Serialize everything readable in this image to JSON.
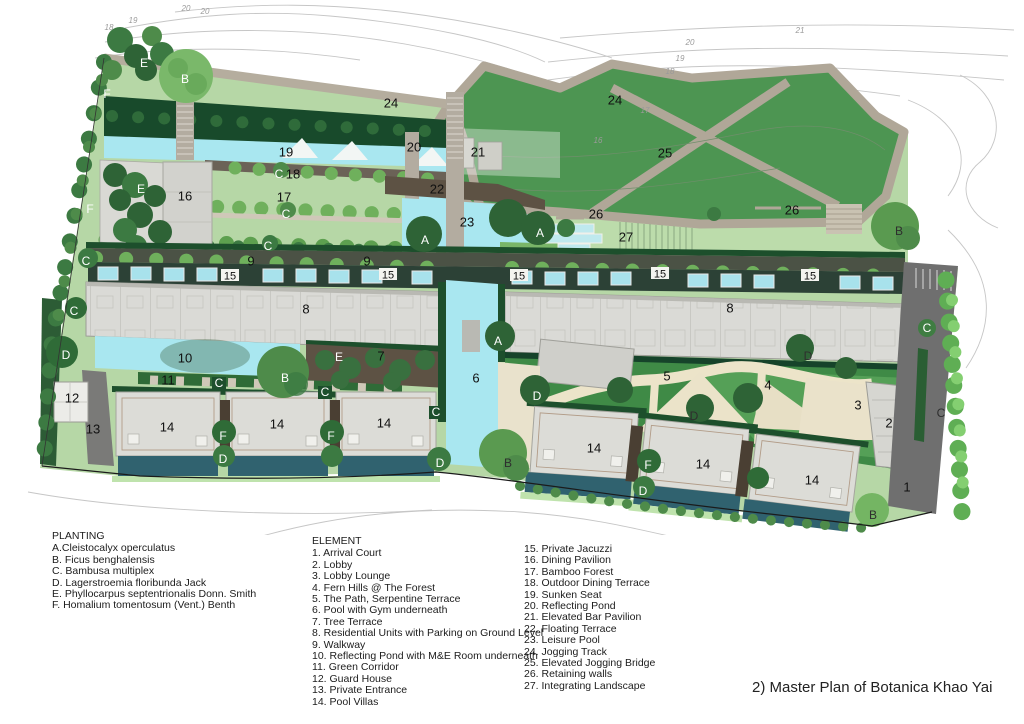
{
  "title": "2) Master Plan of Botanica Khao Yai",
  "legend": {
    "planting": {
      "heading": "PLANTING",
      "items": [
        "A.Cleistocalyx operculatus",
        "B. Ficus benghalensis",
        "C. Bambusa multiplex",
        "D. Lagerstroemia floribunda Jack",
        "E. Phyllocarpus septentrionalis Donn. Smith",
        "F. Homalium tomentosum (Vent.) Benth"
      ]
    },
    "element": {
      "heading": "ELEMENT",
      "col1": [
        "1. Arrival Court",
        "2. Lobby",
        "3. Lobby Lounge",
        "4. Fern Hills @ The Forest",
        "5. The Path, Serpentine Terrace",
        "6. Pool with Gym underneath",
        "7. Tree Terrace",
        "8. Residential Units with Parking on Ground Level",
        "9. Walkway",
        "10. Reflecting Pond with M&E Room underneath",
        "11. Green Corridor",
        "12. Guard House",
        "13. Private Entrance",
        "14. Pool Villas"
      ],
      "col2": [
        "15. Private Jacuzzi",
        "16. Dining Pavilion",
        "17. Bamboo Forest",
        "18. Outdoor Dining Terrace",
        "19. Sunken Seat",
        "20. Reflecting Pond",
        "21. Elevated Bar Pavilion",
        "22. Floating Terrace",
        "23. Leisure Pool",
        "24. Jogging Track",
        "25. Elevated Jogging Bridge",
        "26. Retaining walls",
        "27. Integrating Landscape"
      ]
    }
  },
  "plan": {
    "palette": {
      "water": "#a9e7f0",
      "pool_villa_water": "#30626f",
      "lawn": "#b6d7a6",
      "hill_green": "#4d9552",
      "forest_dark": "#184a2b",
      "serpentine_green": "#3f8a46",
      "track_tan": "#b0a798",
      "sand_path": "#ece4c9",
      "building_gray": "#dadad6",
      "terrace_brown": "#5d5244",
      "road_gray": "#6f6f6f",
      "contour_gray": "#c6c6c6"
    },
    "markers": [
      {
        "t": "1",
        "x": 907,
        "y": 487,
        "k": "n"
      },
      {
        "t": "2",
        "x": 889,
        "y": 423,
        "k": "n"
      },
      {
        "t": "3",
        "x": 858,
        "y": 405,
        "k": "n"
      },
      {
        "t": "4",
        "x": 768,
        "y": 385,
        "k": "n"
      },
      {
        "t": "5",
        "x": 667,
        "y": 376,
        "k": "n"
      },
      {
        "t": "6",
        "x": 476,
        "y": 378,
        "k": "n"
      },
      {
        "t": "7",
        "x": 381,
        "y": 356,
        "k": "n"
      },
      {
        "t": "8",
        "x": 306,
        "y": 309,
        "k": "n"
      },
      {
        "t": "8",
        "x": 730,
        "y": 308,
        "k": "n"
      },
      {
        "t": "9",
        "x": 251,
        "y": 261,
        "k": "n"
      },
      {
        "t": "9",
        "x": 367,
        "y": 261,
        "k": "n"
      },
      {
        "t": "10",
        "x": 185,
        "y": 358,
        "k": "n"
      },
      {
        "t": "11",
        "x": 168,
        "y": 380,
        "k": "n"
      },
      {
        "t": "12",
        "x": 72,
        "y": 398,
        "k": "n"
      },
      {
        "t": "13",
        "x": 93,
        "y": 429,
        "k": "n"
      },
      {
        "t": "14",
        "x": 167,
        "y": 427,
        "k": "n"
      },
      {
        "t": "14",
        "x": 277,
        "y": 424,
        "k": "n"
      },
      {
        "t": "14",
        "x": 384,
        "y": 423,
        "k": "n"
      },
      {
        "t": "14",
        "x": 594,
        "y": 448,
        "k": "n"
      },
      {
        "t": "14",
        "x": 703,
        "y": 464,
        "k": "n"
      },
      {
        "t": "14",
        "x": 812,
        "y": 480,
        "k": "n"
      },
      {
        "t": "15",
        "x": 230,
        "y": 276,
        "k": "p"
      },
      {
        "t": "15",
        "x": 388,
        "y": 275,
        "k": "p"
      },
      {
        "t": "15",
        "x": 519,
        "y": 276,
        "k": "p"
      },
      {
        "t": "15",
        "x": 660,
        "y": 274,
        "k": "p"
      },
      {
        "t": "15",
        "x": 810,
        "y": 276,
        "k": "p"
      },
      {
        "t": "16",
        "x": 185,
        "y": 196,
        "k": "n"
      },
      {
        "t": "17",
        "x": 284,
        "y": 197,
        "k": "n"
      },
      {
        "t": "18",
        "x": 293,
        "y": 174,
        "k": "n"
      },
      {
        "t": "19",
        "x": 286,
        "y": 152,
        "k": "n"
      },
      {
        "t": "20",
        "x": 414,
        "y": 147,
        "k": "n"
      },
      {
        "t": "21",
        "x": 478,
        "y": 152,
        "k": "n"
      },
      {
        "t": "22",
        "x": 437,
        "y": 189,
        "k": "n"
      },
      {
        "t": "23",
        "x": 467,
        "y": 222,
        "k": "n"
      },
      {
        "t": "24",
        "x": 391,
        "y": 103,
        "k": "n"
      },
      {
        "t": "24",
        "x": 615,
        "y": 100,
        "k": "n"
      },
      {
        "t": "25",
        "x": 665,
        "y": 153,
        "k": "n"
      },
      {
        "t": "26",
        "x": 596,
        "y": 214,
        "k": "n"
      },
      {
        "t": "26",
        "x": 792,
        "y": 210,
        "k": "n"
      },
      {
        "t": "27",
        "x": 626,
        "y": 237,
        "k": "n"
      },
      {
        "t": "E",
        "x": 144,
        "y": 63,
        "k": "l",
        "c": "w"
      },
      {
        "t": "B",
        "x": 185,
        "y": 79,
        "k": "l",
        "c": "w"
      },
      {
        "t": "F",
        "x": 107,
        "y": 94,
        "k": "l",
        "c": "w"
      },
      {
        "t": "E",
        "x": 141,
        "y": 189,
        "k": "l",
        "c": "w"
      },
      {
        "t": "F",
        "x": 90,
        "y": 209,
        "k": "l",
        "c": "w"
      },
      {
        "t": "C",
        "x": 279,
        "y": 174,
        "k": "l",
        "c": "w"
      },
      {
        "t": "C",
        "x": 286,
        "y": 214,
        "k": "l",
        "c": "w"
      },
      {
        "t": "C",
        "x": 268,
        "y": 246,
        "k": "l",
        "c": "w"
      },
      {
        "t": "C",
        "x": 86,
        "y": 261,
        "k": "l",
        "c": "w"
      },
      {
        "t": "C",
        "x": 74,
        "y": 311,
        "k": "l",
        "c": "w"
      },
      {
        "t": "D",
        "x": 66,
        "y": 355,
        "k": "l",
        "c": "w"
      },
      {
        "t": "C",
        "x": 219,
        "y": 383,
        "k": "l",
        "c": "w"
      },
      {
        "t": "C",
        "x": 325,
        "y": 392,
        "k": "l",
        "c": "w"
      },
      {
        "t": "C",
        "x": 436,
        "y": 412,
        "k": "l",
        "c": "w"
      },
      {
        "t": "F",
        "x": 223,
        "y": 436,
        "k": "l",
        "c": "w"
      },
      {
        "t": "F",
        "x": 331,
        "y": 436,
        "k": "l",
        "c": "w"
      },
      {
        "t": "D",
        "x": 223,
        "y": 459,
        "k": "l",
        "c": "w"
      },
      {
        "t": "A",
        "x": 425,
        "y": 240,
        "k": "l",
        "c": "w"
      },
      {
        "t": "A",
        "x": 540,
        "y": 233,
        "k": "l",
        "c": "w"
      },
      {
        "t": "A",
        "x": 498,
        "y": 341,
        "k": "l",
        "c": "w"
      },
      {
        "t": "E",
        "x": 339,
        "y": 357,
        "k": "l",
        "c": "w"
      },
      {
        "t": "B",
        "x": 285,
        "y": 378,
        "k": "l",
        "c": "w"
      },
      {
        "t": "D",
        "x": 440,
        "y": 463,
        "k": "l",
        "c": "w"
      },
      {
        "t": "B",
        "x": 508,
        "y": 463,
        "k": "l",
        "c": "d"
      },
      {
        "t": "D",
        "x": 537,
        "y": 396,
        "k": "l",
        "c": "w"
      },
      {
        "t": "D",
        "x": 694,
        "y": 416,
        "k": "l",
        "c": "d"
      },
      {
        "t": "D",
        "x": 808,
        "y": 356,
        "k": "l",
        "c": "d"
      },
      {
        "t": "F",
        "x": 648,
        "y": 465,
        "k": "l",
        "c": "w"
      },
      {
        "t": "D",
        "x": 643,
        "y": 491,
        "k": "l",
        "c": "w"
      },
      {
        "t": "B",
        "x": 899,
        "y": 231,
        "k": "l",
        "c": "d"
      },
      {
        "t": "C",
        "x": 927,
        "y": 328,
        "k": "l",
        "c": "w"
      },
      {
        "t": "C",
        "x": 941,
        "y": 413,
        "k": "l",
        "c": "d"
      },
      {
        "t": "B",
        "x": 873,
        "y": 515,
        "k": "l",
        "c": "d"
      },
      {
        "t": "20",
        "x": 186,
        "y": 8,
        "k": "e"
      },
      {
        "t": "20",
        "x": 205,
        "y": 11,
        "k": "e"
      },
      {
        "t": "19",
        "x": 133,
        "y": 20,
        "k": "e"
      },
      {
        "t": "18",
        "x": 109,
        "y": 27,
        "k": "e"
      },
      {
        "t": "21",
        "x": 800,
        "y": 30,
        "k": "e"
      },
      {
        "t": "20",
        "x": 690,
        "y": 42,
        "k": "e"
      },
      {
        "t": "19",
        "x": 680,
        "y": 58,
        "k": "e"
      },
      {
        "t": "18",
        "x": 670,
        "y": 71,
        "k": "e"
      },
      {
        "t": "17",
        "x": 645,
        "y": 110,
        "k": "e"
      },
      {
        "t": "16",
        "x": 598,
        "y": 140,
        "k": "e"
      }
    ]
  }
}
